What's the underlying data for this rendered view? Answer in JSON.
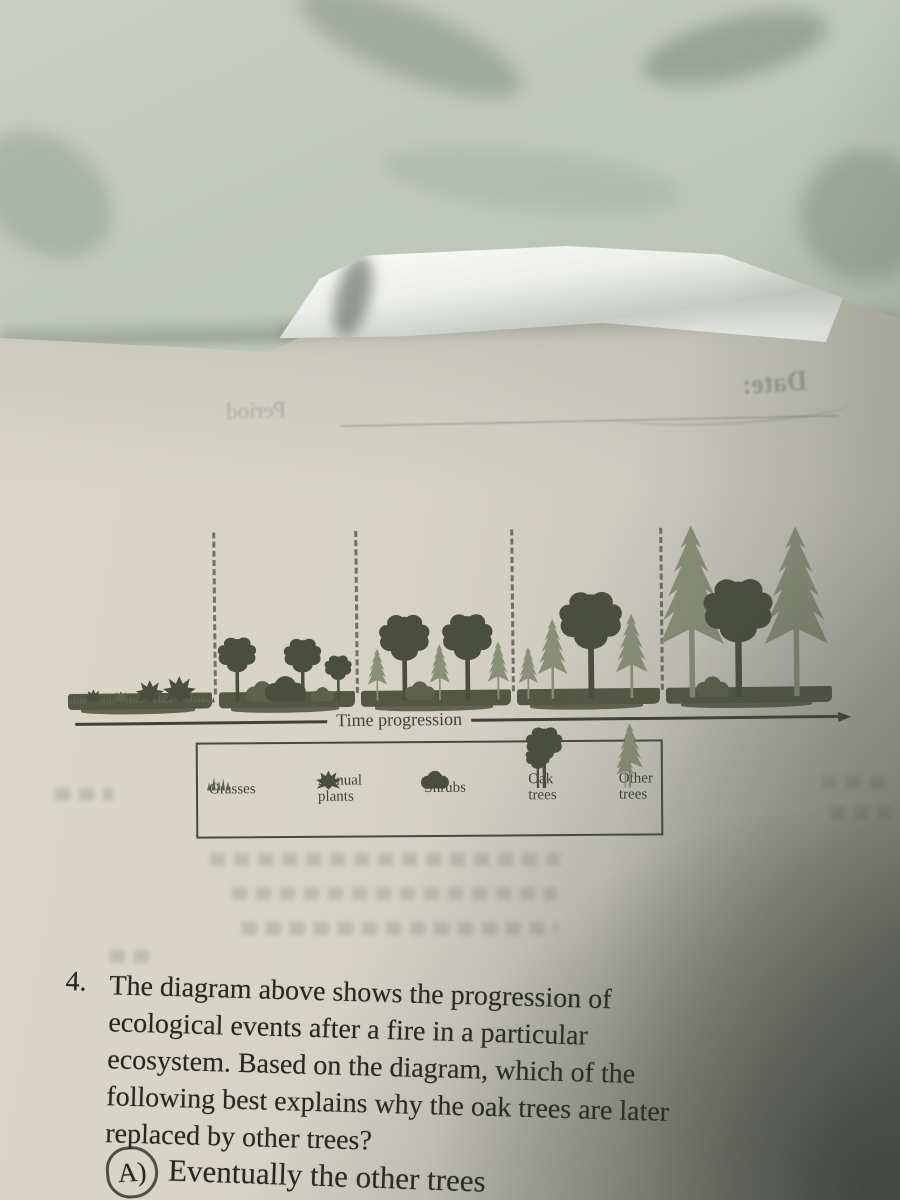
{
  "bleedthrough": {
    "date_label": "Date:",
    "period_label": "Period"
  },
  "diagram": {
    "axis_label": "Time progression",
    "separators": [
      215,
      357,
      513,
      662
    ],
    "ground_segments": [
      [
        68,
        212
      ],
      [
        219,
        355
      ],
      [
        361,
        511
      ],
      [
        517,
        660
      ],
      [
        666,
        832
      ]
    ],
    "vegetation": [
      {
        "type": "grass",
        "x": 78,
        "h": 10,
        "shade": "mid"
      },
      {
        "type": "annual",
        "x": 93,
        "h": 15,
        "shade": "dark"
      },
      {
        "type": "grass",
        "x": 107,
        "h": 9,
        "shade": "mid"
      },
      {
        "type": "annual",
        "x": 121,
        "h": 13,
        "shade": "mid"
      },
      {
        "type": "grass",
        "x": 134,
        "h": 10,
        "shade": "mid"
      },
      {
        "type": "annual",
        "x": 150,
        "h": 24,
        "shade": "dark"
      },
      {
        "type": "grass",
        "x": 163,
        "h": 11,
        "shade": "mid"
      },
      {
        "type": "annual",
        "x": 179,
        "h": 28,
        "shade": "dark"
      },
      {
        "type": "grass",
        "x": 195,
        "h": 11,
        "shade": "mid"
      },
      {
        "type": "grass",
        "x": 207,
        "h": 9,
        "shade": "mid"
      },
      {
        "type": "oak",
        "x": 237,
        "h": 68,
        "shade": "dark"
      },
      {
        "type": "shrub",
        "x": 262,
        "h": 22,
        "shade": "mid"
      },
      {
        "type": "shrub",
        "x": 285,
        "h": 27,
        "shade": "dark"
      },
      {
        "type": "oak",
        "x": 303,
        "h": 66,
        "shade": "dark"
      },
      {
        "type": "shrub",
        "x": 322,
        "h": 15,
        "shade": "mid"
      },
      {
        "type": "oak",
        "x": 338,
        "h": 48,
        "shade": "dark"
      },
      {
        "type": "conifer",
        "x": 377,
        "h": 52,
        "shade": "light"
      },
      {
        "type": "oak",
        "x": 405,
        "h": 90,
        "shade": "dark"
      },
      {
        "type": "shrub",
        "x": 420,
        "h": 20,
        "shade": "mid"
      },
      {
        "type": "conifer",
        "x": 440,
        "h": 56,
        "shade": "light"
      },
      {
        "type": "oak",
        "x": 468,
        "h": 90,
        "shade": "dark"
      },
      {
        "type": "conifer",
        "x": 498,
        "h": 58,
        "shade": "light"
      },
      {
        "type": "conifer",
        "x": 528,
        "h": 52,
        "shade": "light"
      },
      {
        "type": "conifer",
        "x": 553,
        "h": 80,
        "shade": "light"
      },
      {
        "type": "conifer",
        "x": 632,
        "h": 84,
        "shade": "light"
      },
      {
        "type": "oak",
        "x": 591,
        "h": 112,
        "shade": "dark"
      },
      {
        "type": "conifer",
        "x": 692,
        "h": 172,
        "shade": "light"
      },
      {
        "type": "shrub",
        "x": 712,
        "h": 22,
        "shade": "mid"
      },
      {
        "type": "conifer",
        "x": 797,
        "h": 170,
        "shade": "light"
      },
      {
        "type": "oak",
        "x": 739,
        "h": 124,
        "shade": "dark"
      }
    ]
  },
  "legend": {
    "items": [
      {
        "icon": "grasses",
        "label": "Grasses"
      },
      {
        "icon": "annual-plants",
        "label": "Annual\nplants"
      },
      {
        "icon": "shrubs",
        "label": "Shrubs"
      },
      {
        "icon": "oak-trees",
        "label": "Oak\ntrees"
      },
      {
        "icon": "other-trees",
        "label": "Other\ntrees"
      }
    ]
  },
  "question": {
    "number": "4.",
    "lines": [
      "The diagram above shows the progression of",
      "ecological events after a fire in a particular",
      "ecosystem. Based on the diagram, which of the",
      "following best explains why the oak trees are later",
      "replaced by other trees?"
    ]
  },
  "answer_choice": {
    "label": "A)",
    "text": "Eventually the other trees",
    "circled": true
  },
  "colors": {
    "ink": "#29281f",
    "ink_soft": "#3f4336",
    "veg_dark": "#4a4e3c",
    "veg_mid": "#5d624c",
    "veg_light": "#8a9078",
    "ground": "#545843",
    "dash": "#5c6150",
    "legend_border": "#454a3c",
    "page": "#d6d3c5",
    "marble": "#bcc4b8"
  }
}
